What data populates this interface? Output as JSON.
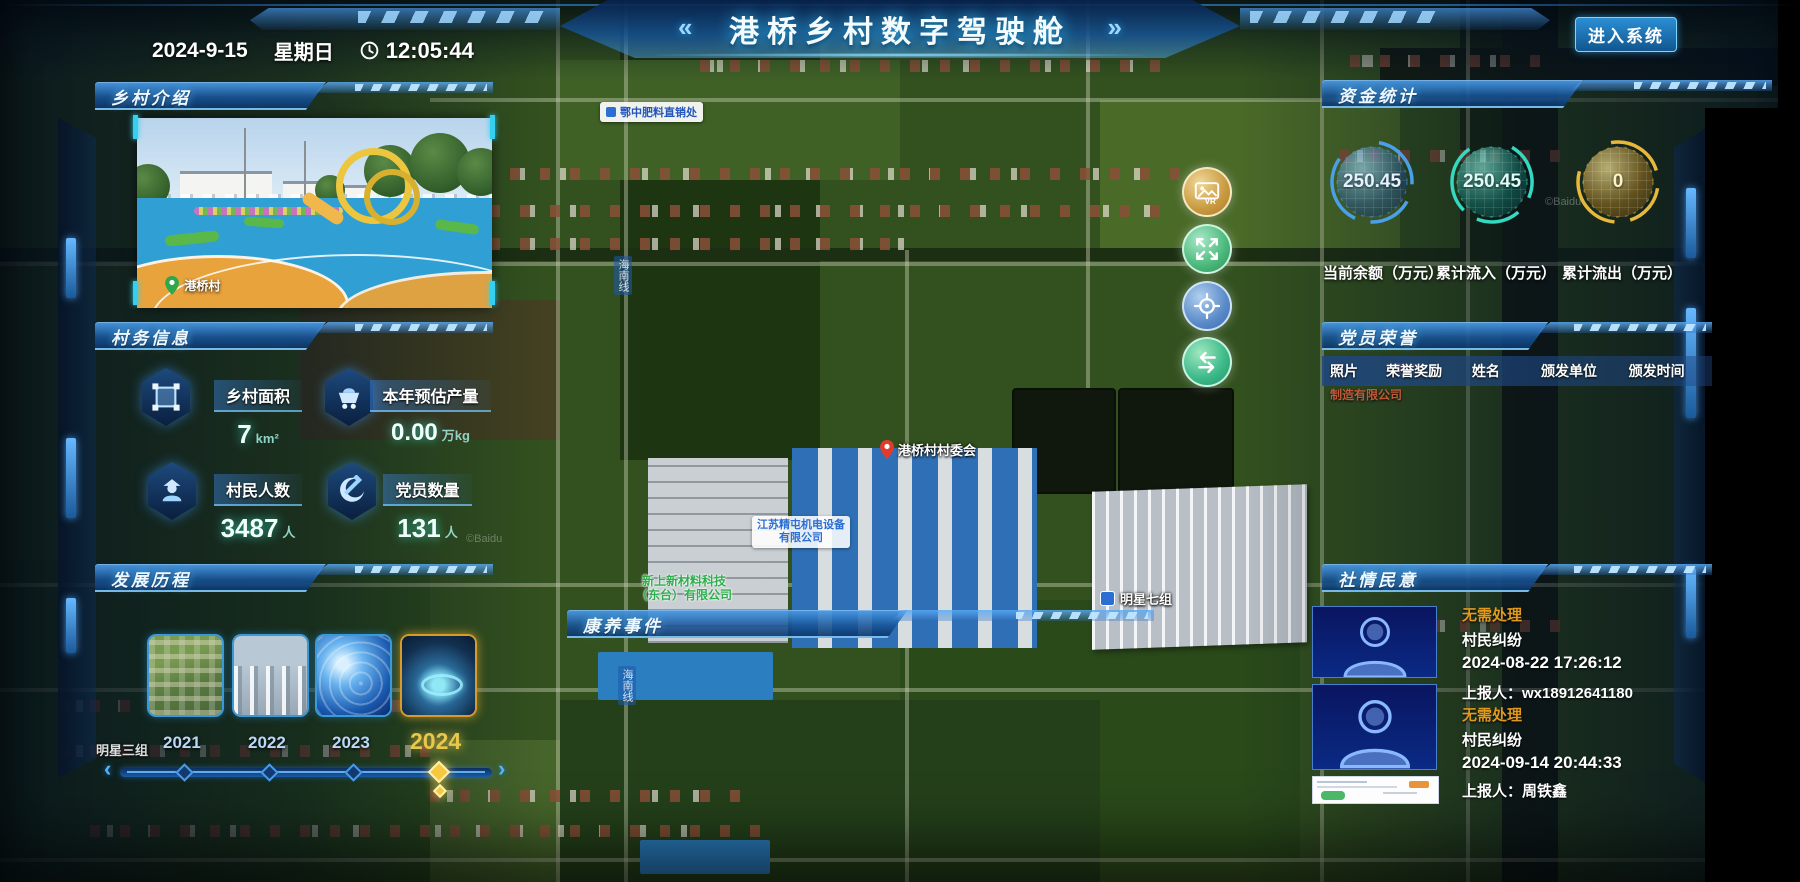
{
  "header": {
    "title": "港桥乡村数字驾驶舱",
    "left_arrows": "«",
    "right_arrows": "»",
    "date": "2024-9-15",
    "weekday": "星期日",
    "time": "12:05:44",
    "enter_button": "进入系统"
  },
  "panels": {
    "village_intro": {
      "title": "乡村介绍",
      "photo_location": "港桥村"
    },
    "village_info": {
      "title": "村务信息",
      "stats": [
        {
          "label": "乡村面积",
          "value": "7",
          "unit": "km²"
        },
        {
          "label": "本年预估产量",
          "value": "0.00",
          "unit": "万kg"
        },
        {
          "label": "村民人数",
          "value": "3487",
          "unit": "人"
        },
        {
          "label": "党员数量",
          "value": "131",
          "unit": "人"
        }
      ]
    },
    "development": {
      "title": "发展历程",
      "years": [
        "2021",
        "2022",
        "2023",
        "2024"
      ],
      "active_year": "2024"
    },
    "funds": {
      "title": "资金统计",
      "gauges": [
        {
          "value": "250.45",
          "label": "当前余额（万元）",
          "color": "#4aa0e8"
        },
        {
          "value": "250.45",
          "label": "累计流入（万元）",
          "color": "#35d8c0"
        },
        {
          "value": "0",
          "label": "累计流出（万元）",
          "color": "#e8b83a"
        }
      ]
    },
    "party_honor": {
      "title": "党员荣誉",
      "columns": [
        "照片",
        "荣誉奖励",
        "姓名",
        "颁发单位",
        "颁发时间"
      ]
    },
    "public_opinion": {
      "title": "社情民意",
      "items": [
        {
          "status": "无需处理",
          "type": "村民纠纷",
          "time": "2024-08-22 17:26:12",
          "reporter": "上报人：wx18912641180"
        },
        {
          "status": "无需处理",
          "type": "村民纠纷",
          "time": "2024-09-14 20:44:33",
          "reporter": "上报人：周铁鑫"
        }
      ]
    },
    "health_events": {
      "title": "康养事件"
    }
  },
  "map_tools": [
    {
      "name": "vr-panorama",
      "label": "VR"
    },
    {
      "name": "expand-fullscreen"
    },
    {
      "name": "locate-center"
    },
    {
      "name": "swap-refresh"
    }
  ],
  "map": {
    "labels": {
      "fertilizer_store": "鄂中肥料直销处",
      "village_committee": "港桥村村委会",
      "company_blue_line1": "江苏精屯机电设备",
      "company_blue_line2": "有限公司",
      "company_green_line1": "新上新材料科技",
      "company_green_line2": "（东台）有限公司",
      "company_partial_line1": "睿智",
      "company_partial_line2": "制造有限公司",
      "group7": "明星七组",
      "group3": "明星三组",
      "road_name": "海南线"
    },
    "watermark": "©Baidu"
  },
  "colors": {
    "accent_blue": "#35a8f0",
    "status_warning": "#e09a1d",
    "gauge_blue": "#4aa0e8",
    "gauge_teal": "#35d8c0",
    "gauge_gold": "#e8b83a",
    "active_year_gold": "#e8c84a"
  }
}
